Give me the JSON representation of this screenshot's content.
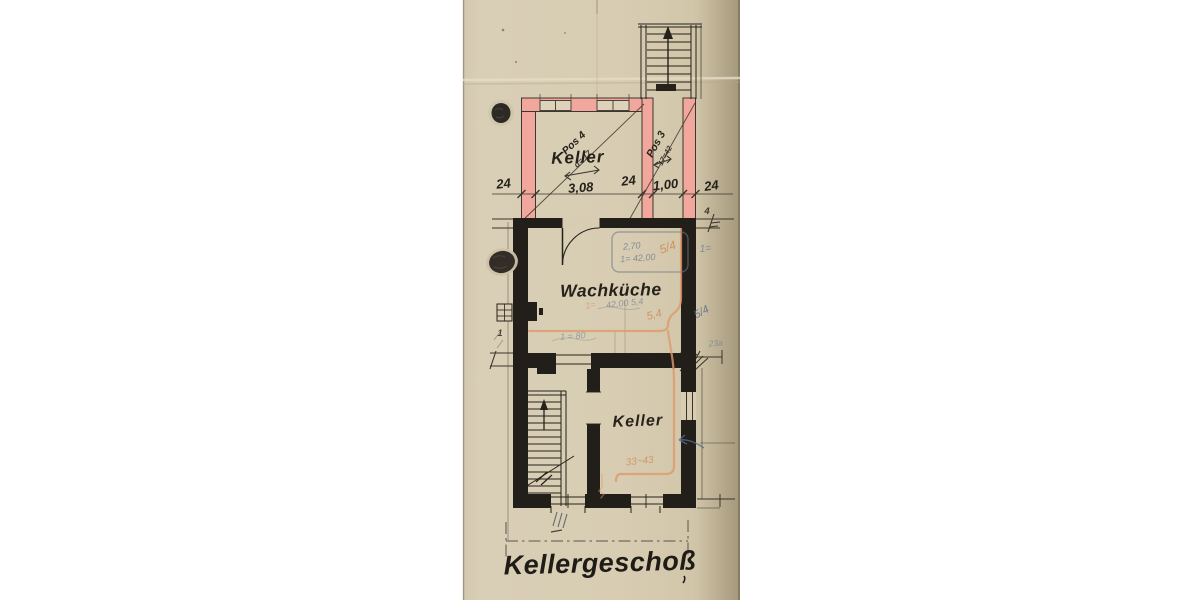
{
  "title": {
    "label": "Kellergeschoß"
  },
  "rooms": {
    "upper_keller": "Keller",
    "wash_kitchen": "Wachküche",
    "lower_keller": "Keller"
  },
  "dimension_row": {
    "wall_left": "24",
    "span_keller": "3,08",
    "wall_mid": "24",
    "corridor": "1,00",
    "wall_right": "24"
  },
  "position_notes": {
    "pos4": "Pos 4",
    "pos4_detail": "d= 17",
    "pos3": "Pos 3",
    "pos3_detail": "17=42"
  },
  "pencil_notes": {
    "box_a": "2,70",
    "box_b": "1= 42,00",
    "box_c": "5/4",
    "right_a": "1=",
    "mid_a": "42,00  5,4",
    "mid_b": "5,4",
    "right_b": "5/4",
    "right_c": "23a",
    "mid_c": "1 = 80",
    "mid_d": "1=",
    "lower_a": "33~43",
    "wall_mark": "1",
    "top_mark": "4"
  },
  "colors": {
    "paper": "#d7ccb2",
    "ink": "#26221b",
    "wall_pink": "#f2a79c",
    "pencil_orange": "#de9a6b",
    "pencil_blue": "#64748c"
  }
}
